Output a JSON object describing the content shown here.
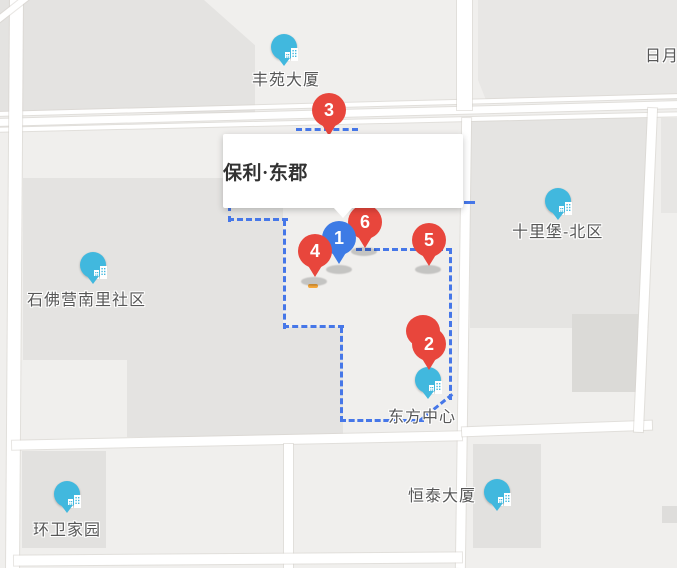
{
  "info_window": {
    "title": "保利·东郡"
  },
  "markers": [
    {
      "number": "1",
      "color": "#3d7be5"
    },
    {
      "number": "2",
      "color": "#e8463c"
    },
    {
      "number": "3",
      "color": "#e8463c"
    },
    {
      "number": "4",
      "color": "#e8463c"
    },
    {
      "number": "5",
      "color": "#e8463c"
    },
    {
      "number": "6",
      "color": "#e8463c"
    }
  ],
  "pois": [
    {
      "label": "丰苑大厦"
    },
    {
      "label": "十里堡-北区"
    },
    {
      "label": "石佛营南里社区"
    },
    {
      "label": "东方中心"
    },
    {
      "label": "恒泰大厦"
    },
    {
      "label": "环卫家园"
    }
  ],
  "edge_labels": [
    {
      "label": "日月"
    }
  ],
  "colors": {
    "red_pin": "#e8463c",
    "blue_pin": "#3d7be5",
    "poi_marker": "#41b8de",
    "boundary_dash": "#4677e8",
    "teal_segment": "#2fc6de",
    "map_base": "#f0efed",
    "block_gray": "#e4e3e1"
  }
}
